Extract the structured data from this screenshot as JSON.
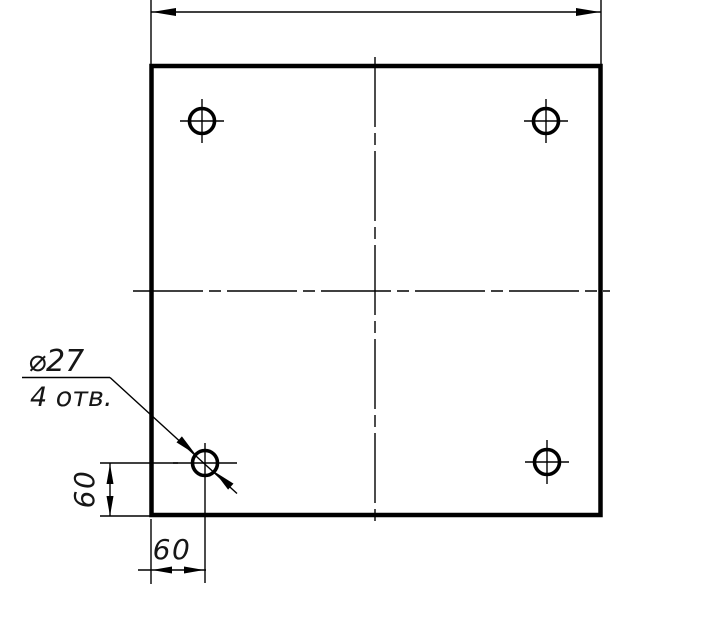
{
  "colors": {
    "background": "#ffffff",
    "line": "#000000",
    "text": "#161616"
  },
  "callout": {
    "diameter_label": "⌀27",
    "holes_note": "4 отв."
  },
  "dimensions": {
    "left_offset": "60",
    "bottom_offset": "60"
  }
}
